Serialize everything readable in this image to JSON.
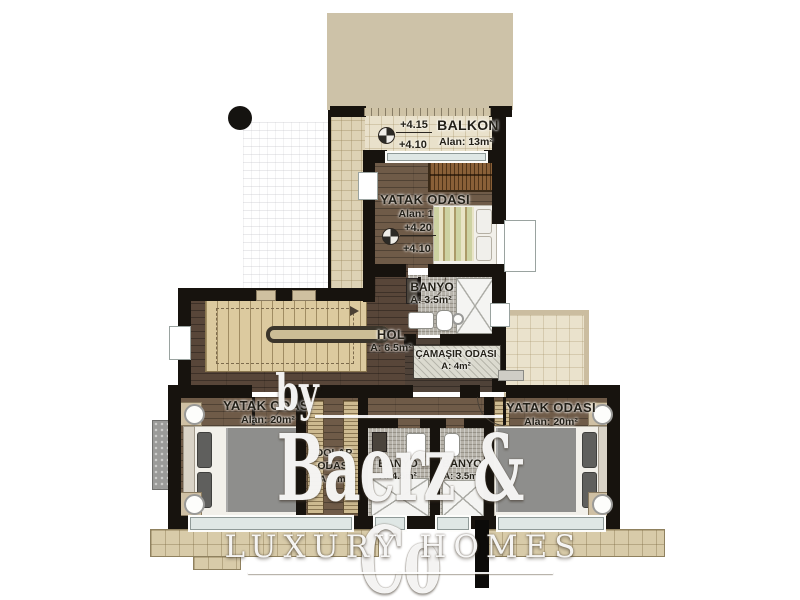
{
  "plan": {
    "balkon": {
      "name": "BALKON",
      "area": "Alan: 13m²",
      "level_upper": "+4.15",
      "level_lower": "+4.10"
    },
    "bedroom_top": {
      "name": "YATAK ODASI",
      "area": "Alan: 1",
      "level_upper": "+4.20",
      "level_lower": "+4.10"
    },
    "banyo_top": {
      "name": "BANYO",
      "area": "A: 3.5m²"
    },
    "hol": {
      "name": "HOL",
      "area": "A: 6.5m²"
    },
    "camasir": {
      "name": "ÇAMAŞIR ODASI",
      "area": "A: 4m²"
    },
    "bedroom_left": {
      "name": "YATAK ODASI",
      "area": "Alan: 20m²"
    },
    "dolap": {
      "name_line1": "DOLAP",
      "name_line2": "ODASI",
      "area": "A: 7m²"
    },
    "banyo_left": {
      "name": "BANYO",
      "area": "A: 4.5m²"
    },
    "banyo_right": {
      "name": "BANYO",
      "area": "A: 3.5m²"
    },
    "bedroom_right": {
      "name": "YATAK ODASI",
      "area": "Alan: 20m²"
    }
  },
  "watermark": {
    "by": "by",
    "brand": "Baerz & Co",
    "tagline": "LUXURY HOMES"
  },
  "icons": {
    "level_marker": "crosshair-circle",
    "stair_arrow": "triangle-right",
    "plan_dot": "filled-circle"
  },
  "colors": {
    "wall": "#17130e",
    "wood_floor": "#6f5b48",
    "tile": "#e9e1cb",
    "stair": "#dcca9f",
    "mosaic": "#b6b2a9",
    "roof": "#cdc2a8",
    "watermark": "#ffffff"
  }
}
